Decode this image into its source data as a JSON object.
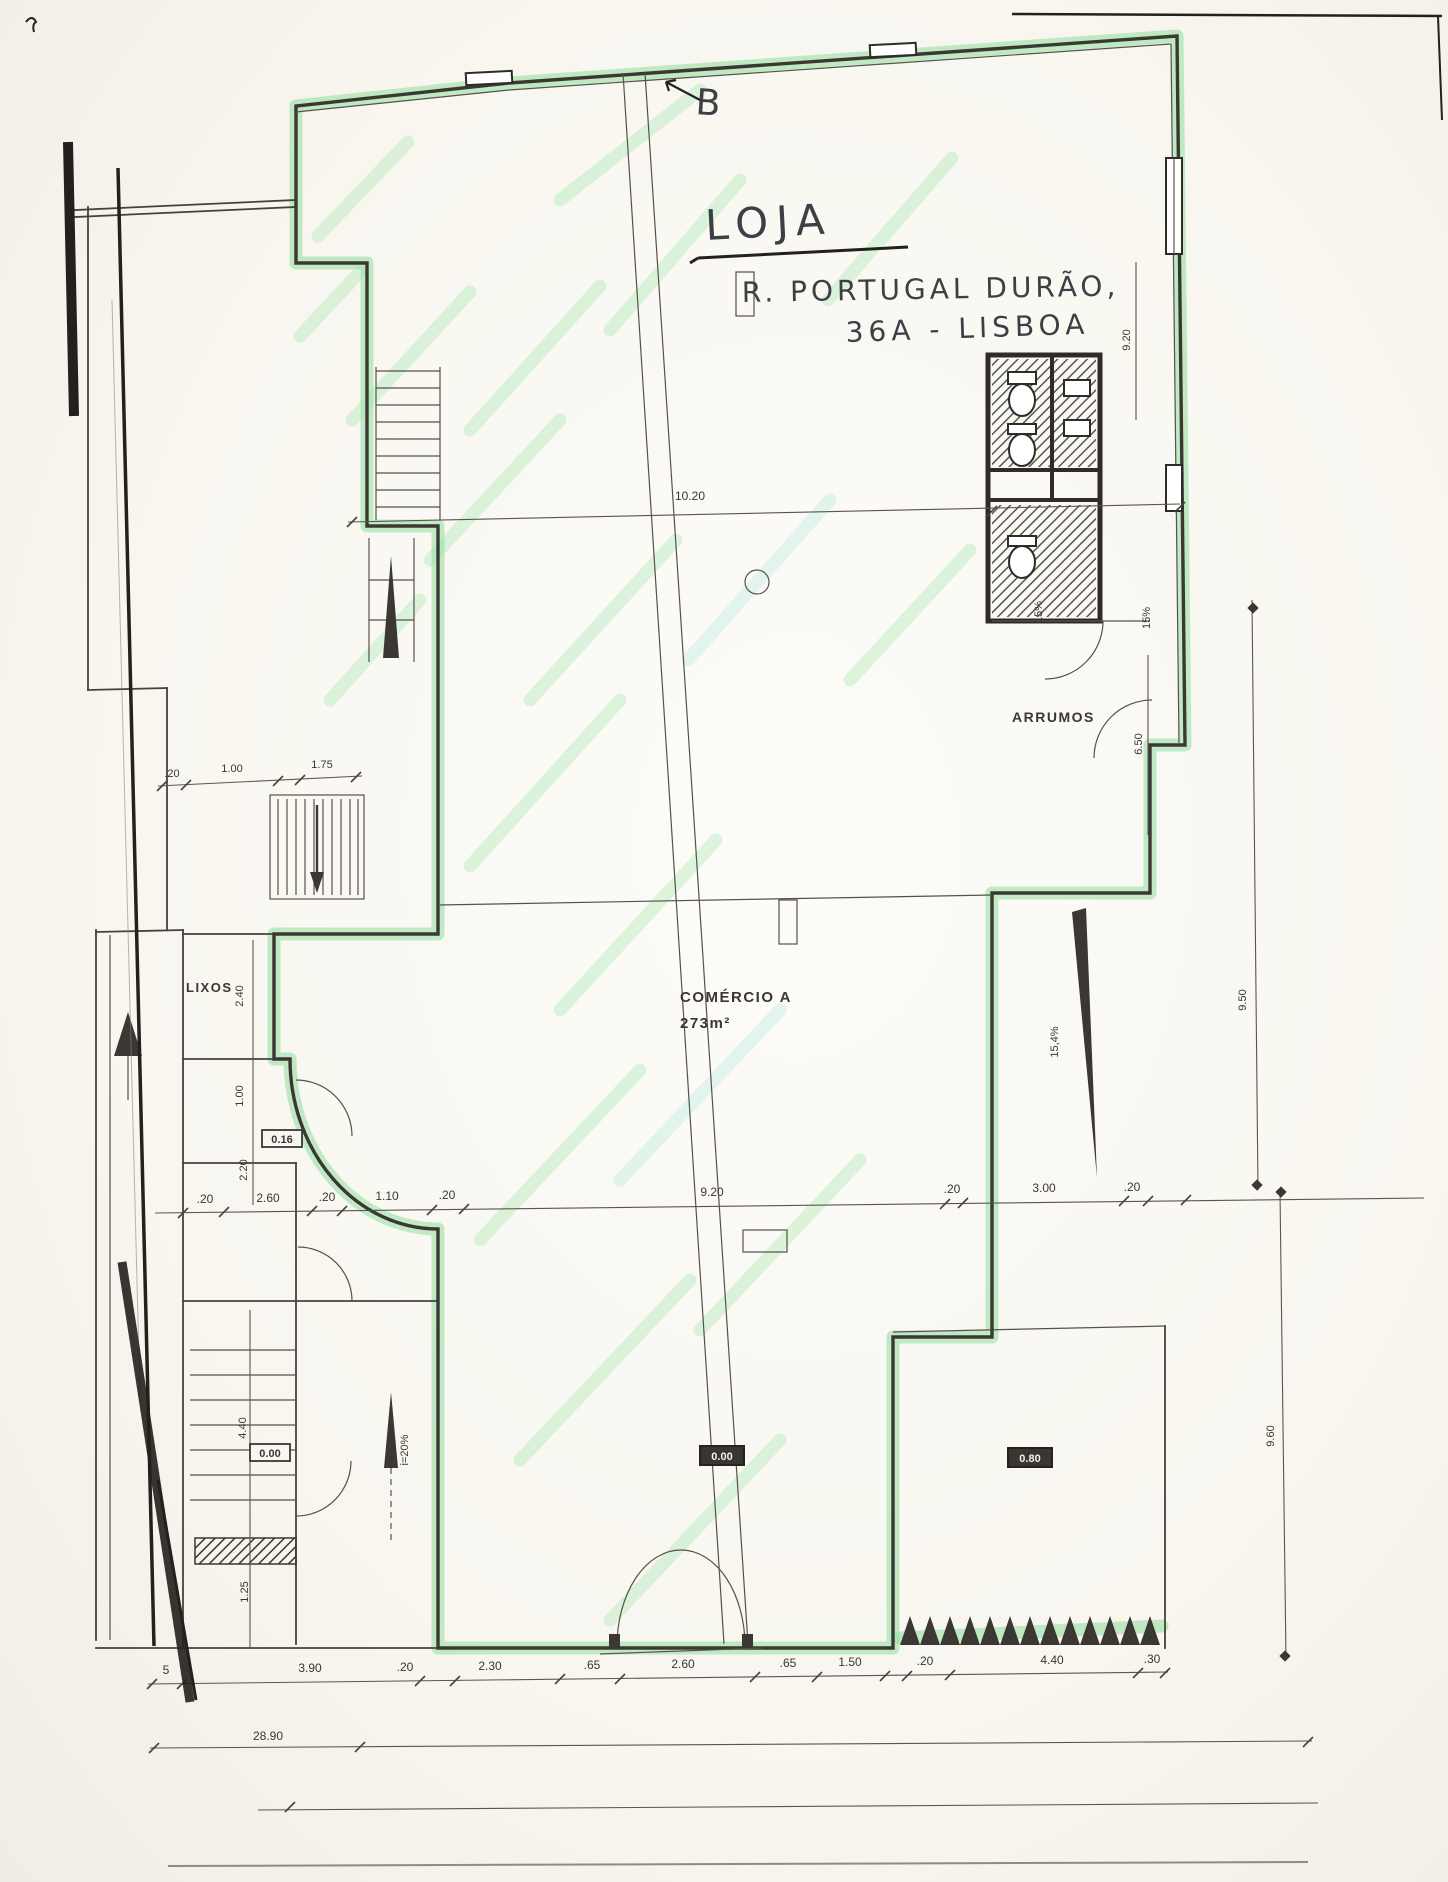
{
  "annotations": {
    "section_letter": "B",
    "title": "LOJA",
    "address_line1": "R. PORTUGAL DURÃO,",
    "address_line2": "36A - LISBOA"
  },
  "rooms": {
    "commerce_name": "COMÉRCIO A",
    "commerce_area": "273m²",
    "storage": "ARRUMOS",
    "trash": "LIXOS"
  },
  "slopes": {
    "left_ramp": "i=20%",
    "right_ramp": "15,4%",
    "wc_ramp_1": "15%",
    "wc_ramp_2": "15%"
  },
  "levels": {
    "corridor": "0.16",
    "left": "0.00",
    "center": "0.00",
    "right": "0.80"
  },
  "dimensions": {
    "top_width": "10.20",
    "upper_left_row": [
      ".20",
      "1.00",
      "1.75"
    ],
    "middle_row": [
      ".20",
      "2.60",
      ".20",
      "1.10",
      ".20",
      "9.20",
      ".20",
      "3.00",
      ".20"
    ],
    "bottom_row": [
      "5",
      "3.90",
      ".20",
      "2.30",
      ".65",
      "2.60",
      ".65",
      "1.50",
      ".20",
      "4.40",
      ".30"
    ],
    "overall_width": "28.90",
    "right_wall_top": "9.20",
    "storage_depth": "6.50",
    "right_margin_upper": "9.50",
    "right_margin_lower": "9.60",
    "left_column": [
      "2.40",
      "1.00",
      "2.20",
      "4.40",
      "1.25"
    ]
  },
  "colors": {
    "highlight_green": "#8fdf9f",
    "highlight_cyan": "#b8e9e0",
    "ink": "#3a3733",
    "paper": "#f8f6f0"
  }
}
